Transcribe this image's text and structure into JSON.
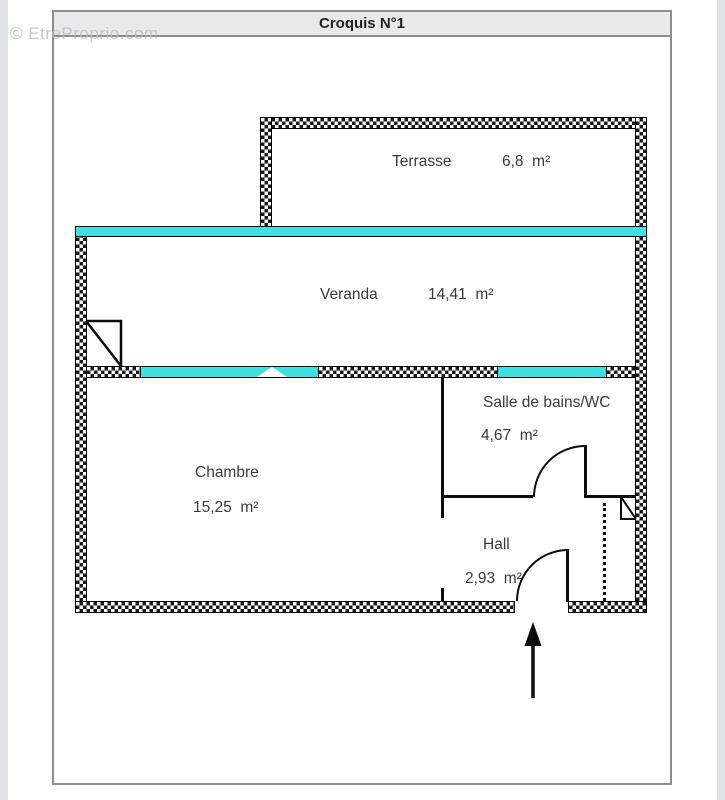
{
  "page": {
    "title": "Croquis N°1",
    "watermark": "© EtreProprio.com"
  },
  "rooms": [
    {
      "id": "terrasse",
      "name": "Terrasse",
      "area": "6,8  m²"
    },
    {
      "id": "veranda",
      "name": "Veranda",
      "area": "14,41  m²"
    },
    {
      "id": "salle-de-bains",
      "name": "Salle de bains/WC",
      "area": "4,67  m²"
    },
    {
      "id": "chambre",
      "name": "Chambre",
      "area": "15,25  m²"
    },
    {
      "id": "hall",
      "name": "Hall",
      "area": "2,93  m²"
    }
  ],
  "colors": {
    "glazing": "#3FE0E2",
    "wall_ink": "#000000",
    "frame": "#8C8C8C",
    "title_bar_bg": "#E9E9E9",
    "text": "#3A3A3A"
  },
  "icons": {
    "entrance_arrow": "↑",
    "door_swing": "quarter-arc",
    "window_marker": "bowtie"
  }
}
